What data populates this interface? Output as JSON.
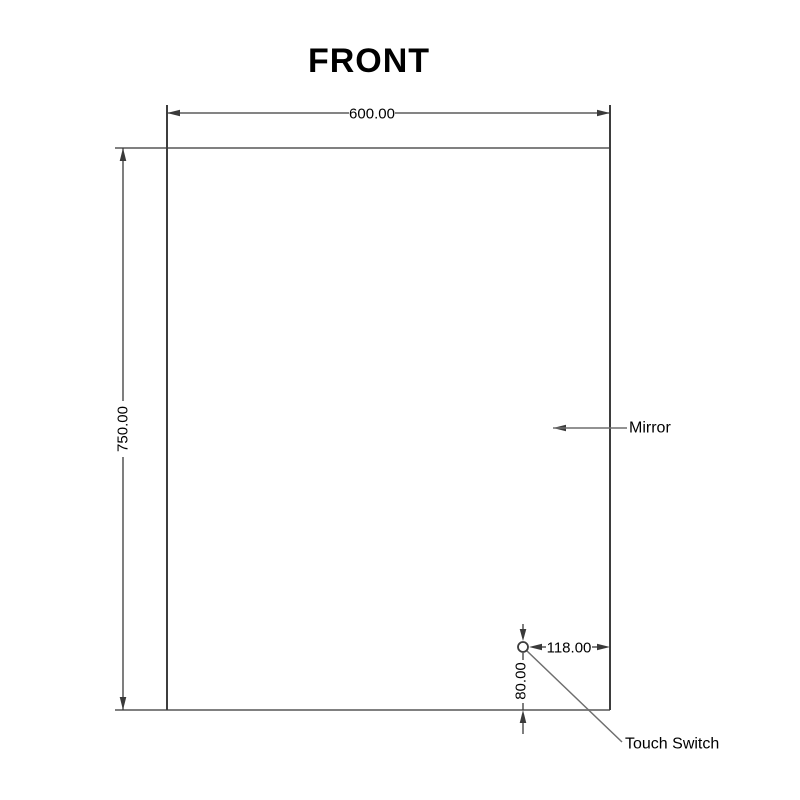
{
  "title": "FRONT",
  "labels": {
    "mirror": "Mirror",
    "touch_switch": "Touch Switch"
  },
  "dimensions": {
    "mirror_width": "600.00",
    "mirror_height": "750.00",
    "switch_from_right": "118.00",
    "switch_from_bottom": "80.00"
  },
  "colors": {
    "background": "#ffffff",
    "outline_horizontal": "#808080",
    "outline_vertical": "#3d3d3d",
    "dimension": "#3a3a3a",
    "leader": "#6e6e6e",
    "text": "#000000"
  }
}
